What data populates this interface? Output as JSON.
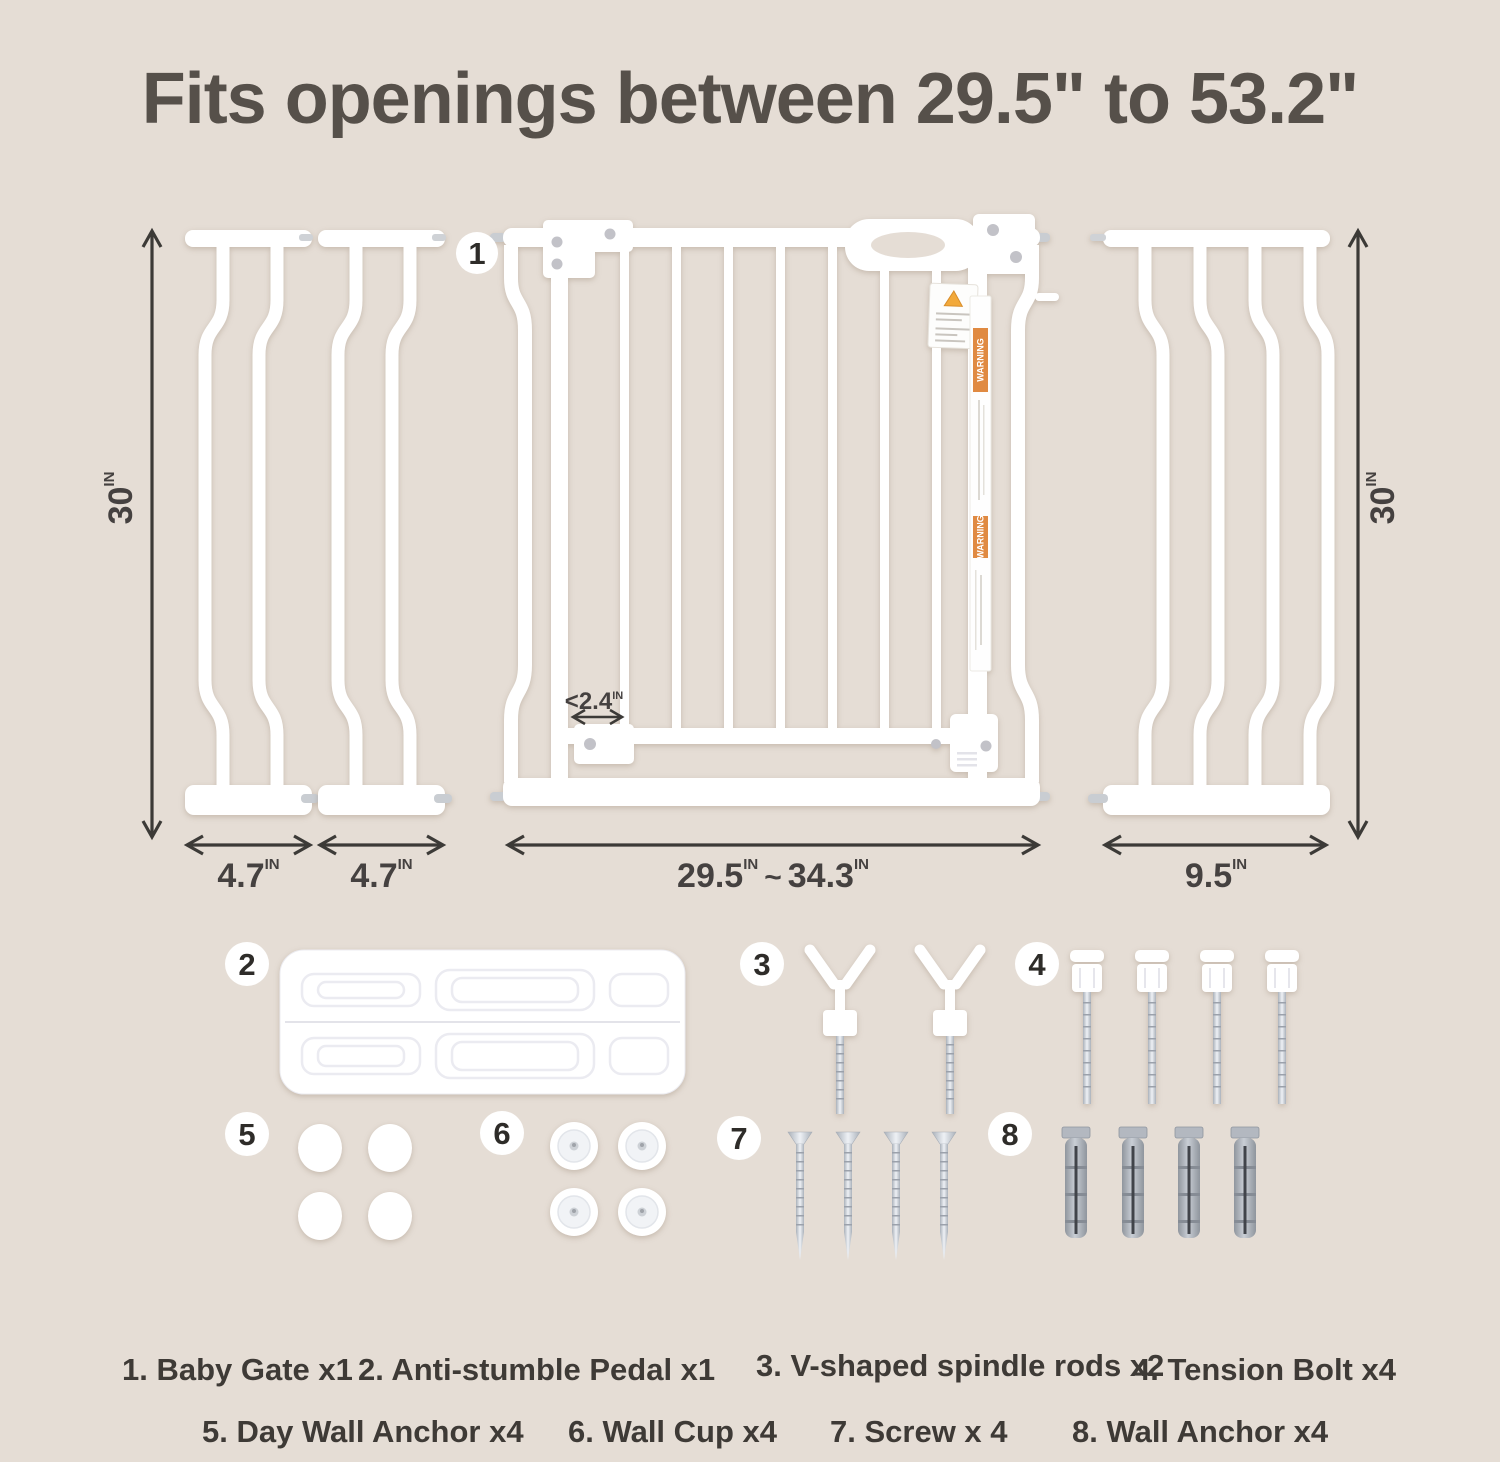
{
  "title": "Fits openings between 29.5\" to 53.2\"",
  "colors": {
    "background": "#e5ddd5",
    "warning_orange": "#e08a42",
    "title_text": "#56504a",
    "dimension_text": "#454140"
  },
  "diagram": {
    "badge_1": "1",
    "warning_strip_text": "WARNING",
    "dims": {
      "left_height": {
        "value": "30",
        "unit": "IN"
      },
      "right_height": {
        "value": "30",
        "unit": "IN"
      },
      "ext_a": {
        "value": "4.7",
        "unit": "IN"
      },
      "ext_b": {
        "value": "4.7",
        "unit": "IN"
      },
      "gate": {
        "from": "29.5",
        "from_unit": "IN",
        "tilde": "~",
        "to": "34.3",
        "to_unit": "IN"
      },
      "ext_right": {
        "value": "9.5",
        "unit": "IN"
      },
      "bar_gap": {
        "value": "<2.4",
        "unit": "IN"
      }
    }
  },
  "parts": {
    "badge_2": "2",
    "badge_3": "3",
    "badge_4": "4",
    "badge_5": "5",
    "badge_6": "6",
    "badge_7": "7",
    "badge_8": "8"
  },
  "legend": {
    "row1": [
      {
        "label": "1. Baby Gate x1"
      },
      {
        "label": "2. Anti-stumble Pedal x1"
      },
      {
        "label": "3. V-shaped spindle rods x2"
      },
      {
        "label": "4. Tension Bolt x4"
      }
    ],
    "row2": [
      {
        "label": "5. Day Wall Anchor x4"
      },
      {
        "label": "6. Wall Cup x4"
      },
      {
        "label": "7. Screw x 4"
      },
      {
        "label": "8. Wall Anchor x4"
      }
    ]
  }
}
